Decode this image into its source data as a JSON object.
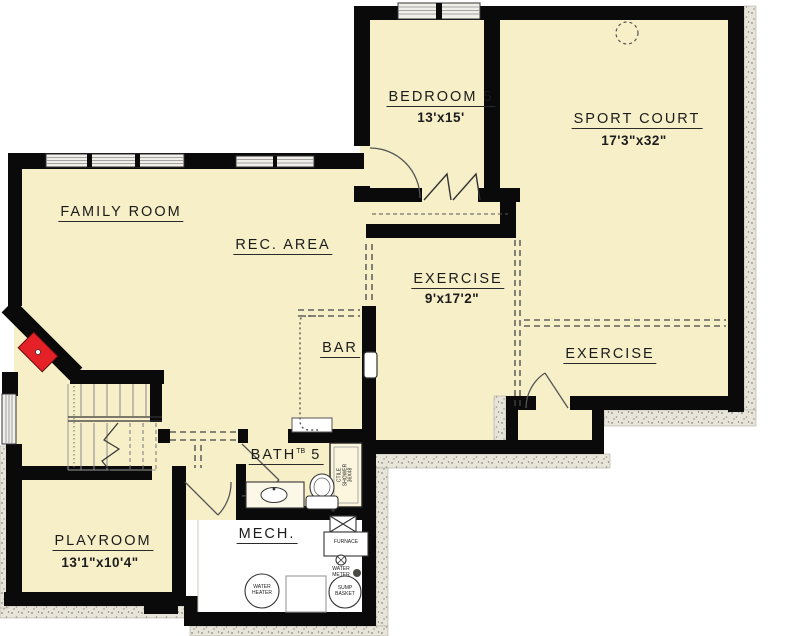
{
  "plan_type": "basement floor plan",
  "colors": {
    "floor": "#f7efc8",
    "wall": "#0a0a0a",
    "fireplace_red": "#e32127",
    "stipple": "#e7e4da"
  },
  "rooms": {
    "family_room": {
      "label": "FAMILY ROOM"
    },
    "rec_area": {
      "label": "REC. AREA"
    },
    "bedroom5": {
      "label": "BEDROOM 5",
      "dims": "13'x15'"
    },
    "sport_court": {
      "label": "SPORT COURT",
      "dims": "17'3\"x32\""
    },
    "exercise_center": {
      "label": "EXERCISE",
      "dims": "9'x17'2\""
    },
    "exercise_right": {
      "label": "EXERCISE"
    },
    "bar": {
      "label": "BAR"
    },
    "bath5": {
      "label": "BATH",
      "sup": "TB",
      "num": "5"
    },
    "mech": {
      "label": "MECH."
    },
    "playroom": {
      "label": "PLAYROOM",
      "dims": "13'1\"x10'4\""
    }
  },
  "fixtures": {
    "shower": [
      "CTILE",
      "SHOWER",
      "36X48"
    ],
    "furnace": "FURNACE",
    "water_meter": [
      "WATER",
      "METER"
    ],
    "water_heater": [
      "WATER",
      "HEATER"
    ],
    "sump_basket": [
      "SUMP",
      "BASKET"
    ]
  }
}
